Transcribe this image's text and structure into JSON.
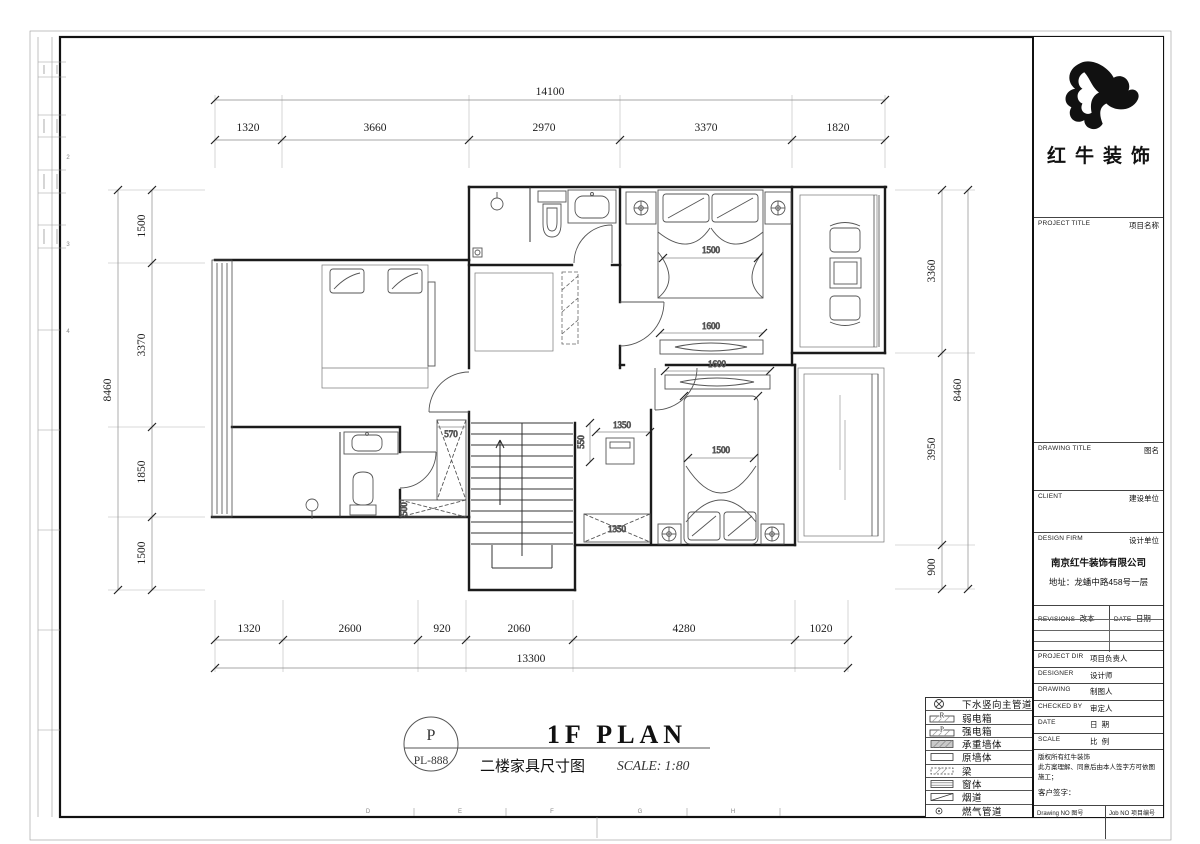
{
  "plan_title": {
    "code_top": "P",
    "code_bottom": "PL-888",
    "name_en": "1F PLAN",
    "name_zh": "二楼家具尺寸图",
    "scale": "SCALE: 1:80"
  },
  "dims": {
    "top_total": "14100",
    "top": [
      "1320",
      "3660",
      "2970",
      "3370",
      "1820"
    ],
    "bottom_total": "13300",
    "bottom": [
      "1320",
      "2600",
      "920",
      "2060",
      "4280",
      "1020"
    ],
    "left_total": "8460",
    "left": [
      "1500",
      "3370",
      "1850",
      "1500"
    ],
    "right_total": "8460",
    "right": [
      "3360",
      "3950",
      "900"
    ],
    "bed_top": "1500",
    "bed_bottom": "1500",
    "tv_top": "1600",
    "tv_bottom": "1600",
    "closet_v": "570",
    "closet_h": "500",
    "nook_d": "550",
    "nook_w": "1350",
    "wardrobe": "1350"
  },
  "legend": {
    "items": [
      {
        "label": "下水竖向主管道"
      },
      {
        "symbol_text": "R",
        "label": "弱电箱"
      },
      {
        "symbol_text": "P",
        "label": "强电箱"
      },
      {
        "label": "承重墙体"
      },
      {
        "label": "原墙体"
      },
      {
        "label": "梁"
      },
      {
        "label": "窗体"
      },
      {
        "label": "烟道"
      },
      {
        "label": "燃气管道"
      }
    ]
  },
  "title_block": {
    "logo_name": "红牛装饰",
    "project_title_en": "PROJECT TITLE",
    "project_title_zh": "项目名称",
    "drawing_title_en": "DRAWING TITLE",
    "drawing_title_zh": "图名",
    "client_en": "CLIENT",
    "client_zh": "建设单位",
    "design_firm_en": "DESIGN FIRM",
    "design_firm_zh": "设计单位",
    "company": "南京红牛装饰有限公司",
    "address": "地址：龙蟠中路458号一层",
    "revisions_en": "REVISIONS",
    "revisions_zh": "改本",
    "date_col_en": "DATE",
    "date_col_zh": "日期",
    "project_dir_en": "PROJECT DIR",
    "project_dir_zh": "项目负责人",
    "designer_en": "DESIGNER",
    "designer_zh": "设计师",
    "drawing_en": "DRAWING",
    "drawing_zh": "制图人",
    "checked_en": "CHECKED BY",
    "checked_zh": "审定人",
    "date_en": "DATE",
    "date_zh": "日  期",
    "scale_en": "SCALE",
    "scale_zh": "比  例",
    "copyright_line1": "版权所有红牛装饰",
    "copyright_line2": "此方案理解、同意后由本人签字方可依图施工；",
    "client_sign": "客户签字：",
    "drawing_no_en": "Drawing NO",
    "drawing_no_zh": "图号",
    "job_no_en": "Job NO",
    "job_no_zh": "项目编号"
  },
  "frame": {
    "grid_letters_bottom": [
      "D",
      "E",
      "F",
      "G",
      "H"
    ],
    "grid_numbers_side": [
      "1",
      "2",
      "3",
      "4",
      "5",
      "6",
      "7",
      "8",
      "9"
    ]
  }
}
